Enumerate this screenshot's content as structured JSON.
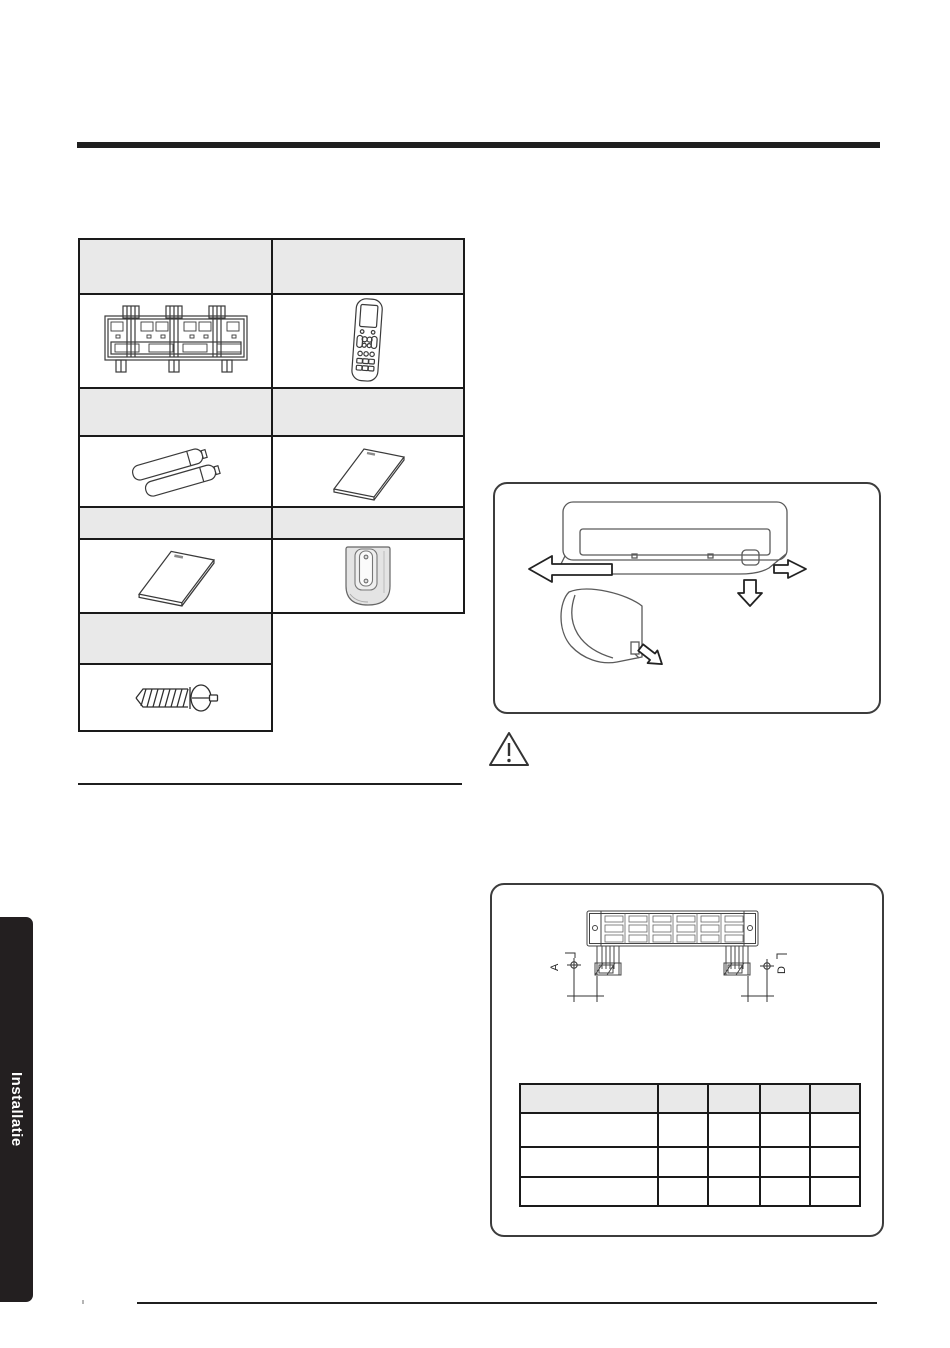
{
  "sidebar": {
    "tab_label": "Installatie"
  },
  "colors": {
    "rule": "#1f1f1f",
    "table_border": "#1a1a1a",
    "header_fill": "#e9e9e9",
    "tab_bg": "#231f20",
    "tab_text": "#ffffff",
    "drawing_stroke": "#3a3a3a"
  },
  "accessories_table": {
    "rows": [
      {
        "kind": "header",
        "cells": [
          "",
          ""
        ]
      },
      {
        "kind": "image",
        "cells": [
          "installation-plate-image",
          "remote-control-image"
        ]
      },
      {
        "kind": "header",
        "cells": [
          "",
          ""
        ]
      },
      {
        "kind": "image",
        "cells": [
          "batteries-image",
          "manual-image"
        ]
      },
      {
        "kind": "header",
        "cells": [
          "",
          ""
        ]
      },
      {
        "kind": "image",
        "cells": [
          "manual-image",
          "remote-holder-image"
        ]
      },
      {
        "kind": "header",
        "cells": [
          ""
        ]
      },
      {
        "kind": "image",
        "cells": [
          "screw-image"
        ]
      }
    ]
  },
  "panel_removal_figure": {
    "arrows": [
      "left",
      "right",
      "down",
      "diagonal-down-right"
    ]
  },
  "warning_icon": "warning-triangle-icon",
  "mounting_figure": {
    "label_left": "A",
    "label_right": "D"
  },
  "dimension_table": {
    "columns": 5,
    "header": [
      "",
      "",
      "",
      "",
      ""
    ],
    "rows": [
      [
        "",
        "",
        "",
        "",
        ""
      ],
      [
        "",
        "",
        "",
        "",
        ""
      ],
      [
        "",
        "",
        "",
        "",
        ""
      ]
    ]
  }
}
